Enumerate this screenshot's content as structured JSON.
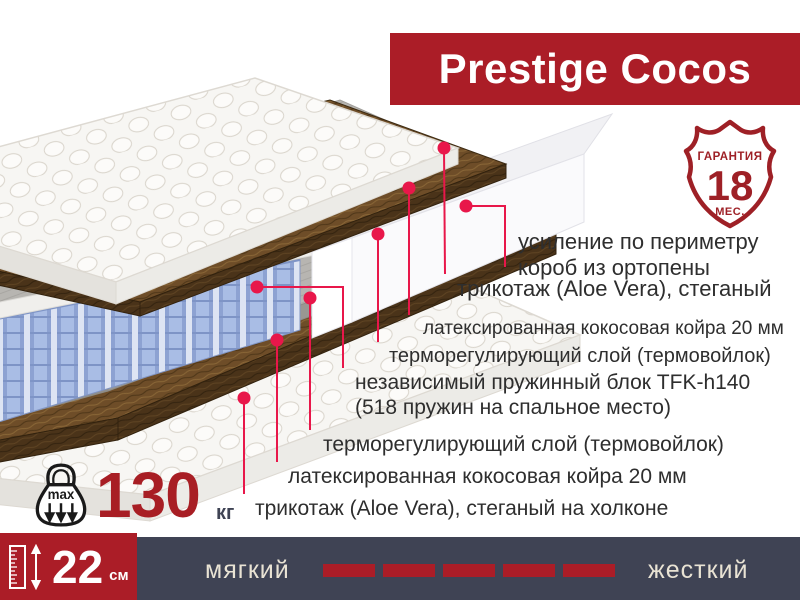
{
  "title": "Prestige Cocos",
  "badge": {
    "top": "ГАРАНТИЯ",
    "value": "18",
    "bottom": "МЕС."
  },
  "layers": [
    {
      "lines": [
        "усиление по периметру",
        "короб из ортопены"
      ]
    },
    {
      "lines": [
        "трикотаж (Aloe Vera), стеганый"
      ]
    },
    {
      "lines": [
        "латексированная кокосовая койра 20 мм"
      ]
    },
    {
      "lines": [
        "терморегулирующий слой (термовойлок)"
      ]
    },
    {
      "lines": [
        "независимый пружинный блок TFK-h140",
        "(518 пружин на спальное место)"
      ]
    },
    {
      "lines": [
        "терморегулирующий слой (термовойлок)"
      ]
    },
    {
      "lines": [
        "латексированная кокосовая койра 20 мм"
      ]
    },
    {
      "lines": [
        "трикотаж (Aloe Vera), стеганый на холконе"
      ]
    }
  ],
  "max_weight": {
    "icon_label": "max",
    "value": "130",
    "unit": "кг"
  },
  "height": {
    "value": "22",
    "unit": "см"
  },
  "firmness": {
    "left": "мягкий",
    "right": "жесткий",
    "dash_count": 5
  },
  "colors": {
    "banner_red": "#ab1d27",
    "leader_red": "#e8174a",
    "navy": "#3f4354",
    "badge_red": "#9e2026",
    "cream_text": "#e9e3d4",
    "label_text": "#2e2e2e",
    "weight_red": "#a81e24"
  }
}
